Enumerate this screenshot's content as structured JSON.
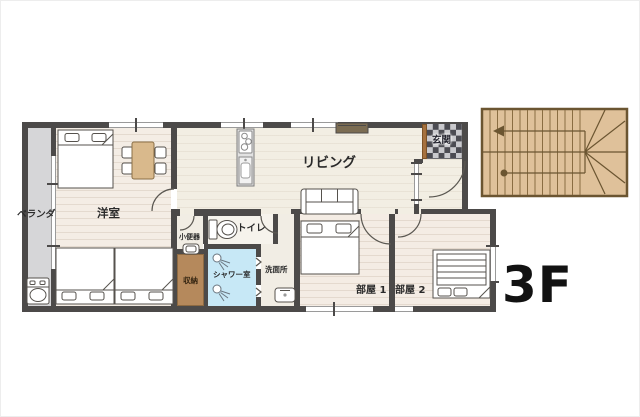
{
  "floor": {
    "label": "3F"
  },
  "rooms": {
    "veranda": {
      "label": "ベランダ"
    },
    "western_room": {
      "label": "洋室"
    },
    "living": {
      "label": "リビング"
    },
    "entrance": {
      "label": "玄関"
    },
    "urinal_room": {
      "label": "小便器"
    },
    "toilet": {
      "label": "トイレ"
    },
    "storage": {
      "label": "収納"
    },
    "shower_room": {
      "label": "シャワー室"
    },
    "washroom": {
      "label": "洗面所"
    },
    "room1": {
      "label": "部屋 1"
    },
    "room2": {
      "label": "部屋 2"
    }
  },
  "colors": {
    "wall": "#4c4a49",
    "floor_cream": "#f2eee3",
    "floor_bedroom": "#f4ece4",
    "veranda_gray": "#d6d6d8",
    "shower_blue": "#c7e8f6",
    "storage_brown": "#b5895c",
    "stair_wood": "#dfc19a",
    "entrance_checker_dark": "#4b4b52",
    "entrance_checker_light": "#c9c9cd",
    "text_dark": "#2a2a2a"
  },
  "fixtures": {
    "staircase": "staircase-icon",
    "washing_machine": "washing-machine-icon",
    "double_bed": "double-bed-icon",
    "single_bed": "single-bed-icon",
    "dining_table": "dining-table-icon",
    "sofa": "sofa-icon",
    "tv_board": "tv-board-icon",
    "stove": "stove-icon",
    "kitchen_sink": "kitchen-sink-icon",
    "toilet": "toilet-icon",
    "urinal": "urinal-icon",
    "shower_head": "shower-head-icon",
    "washbasin": "washbasin-icon"
  }
}
